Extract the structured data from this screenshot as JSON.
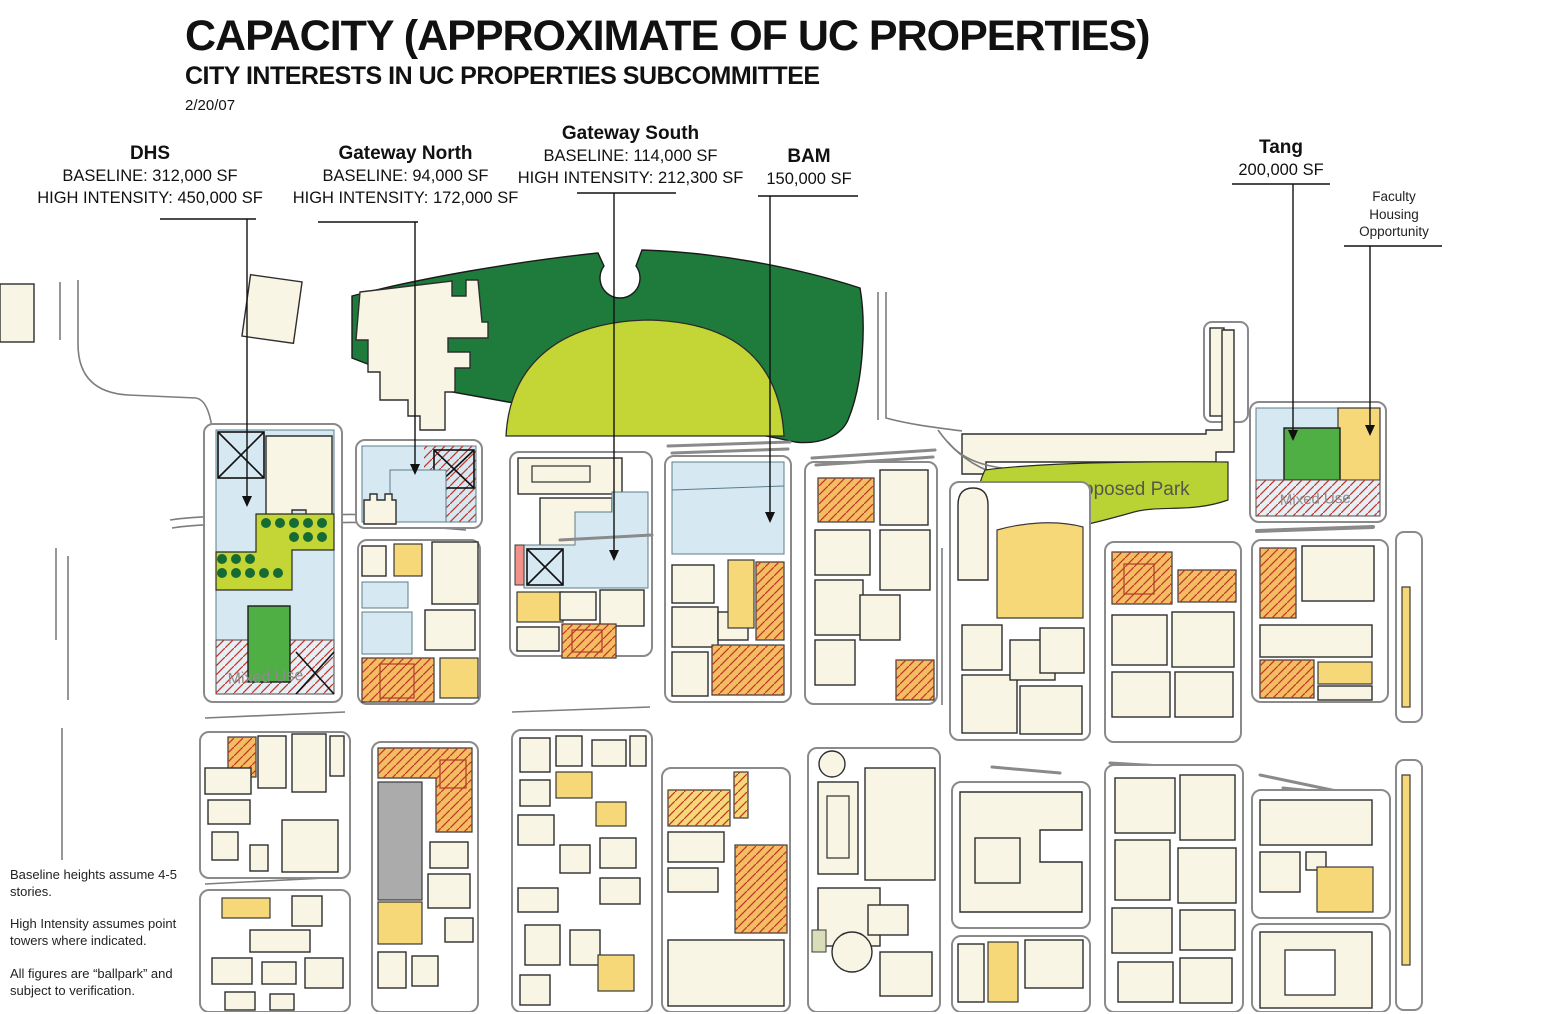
{
  "header": {
    "title": "CAPACITY (APPROXIMATE OF UC PROPERTIES)",
    "subtitle": "CITY INTERESTS IN UC PROPERTIES SUBCOMMITTEE",
    "date": "2/20/07"
  },
  "callouts": {
    "dhs": {
      "name": "DHS",
      "line1": "BASELINE: 312,000 SF",
      "line2": "HIGH INTENSITY: 450,000 SF"
    },
    "gateway_north": {
      "name": "Gateway North",
      "line1": "BASELINE: 94,000 SF",
      "line2": "HIGH INTENSITY: 172,000 SF"
    },
    "gateway_south": {
      "name": "Gateway South",
      "line1": "BASELINE: 114,000 SF",
      "line2": "HIGH INTENSITY: 212,300 SF"
    },
    "bam": {
      "name": "BAM",
      "line1": "150,000 SF"
    },
    "tang": {
      "name": "Tang",
      "line1": "200,000 SF"
    },
    "faculty_housing": {
      "line1": "Faculty",
      "line2": "Housing",
      "line3": "Opportunity"
    }
  },
  "map_labels": {
    "proposed_park": "Proposed Park",
    "mixed_use": "Mixed Use"
  },
  "notes": [
    "Baseline heights assume 4-5 stories.",
    "High Intensity assumes point towers where indicated.",
    "All figures are “ballpark” and subject to verification."
  ],
  "colors": {
    "park_dark_green": "#1e7b3c",
    "park_lime": "#c3d635",
    "uc_property_blue": "#d6e9f2",
    "parcel_yellow": "#f6d878",
    "parcel_orange": "#f4bd62",
    "hatch_red": "#c0392b",
    "building_cream": "#f8f5e4",
    "building_gray": "#ababab",
    "accent_green": "#4fae44"
  }
}
